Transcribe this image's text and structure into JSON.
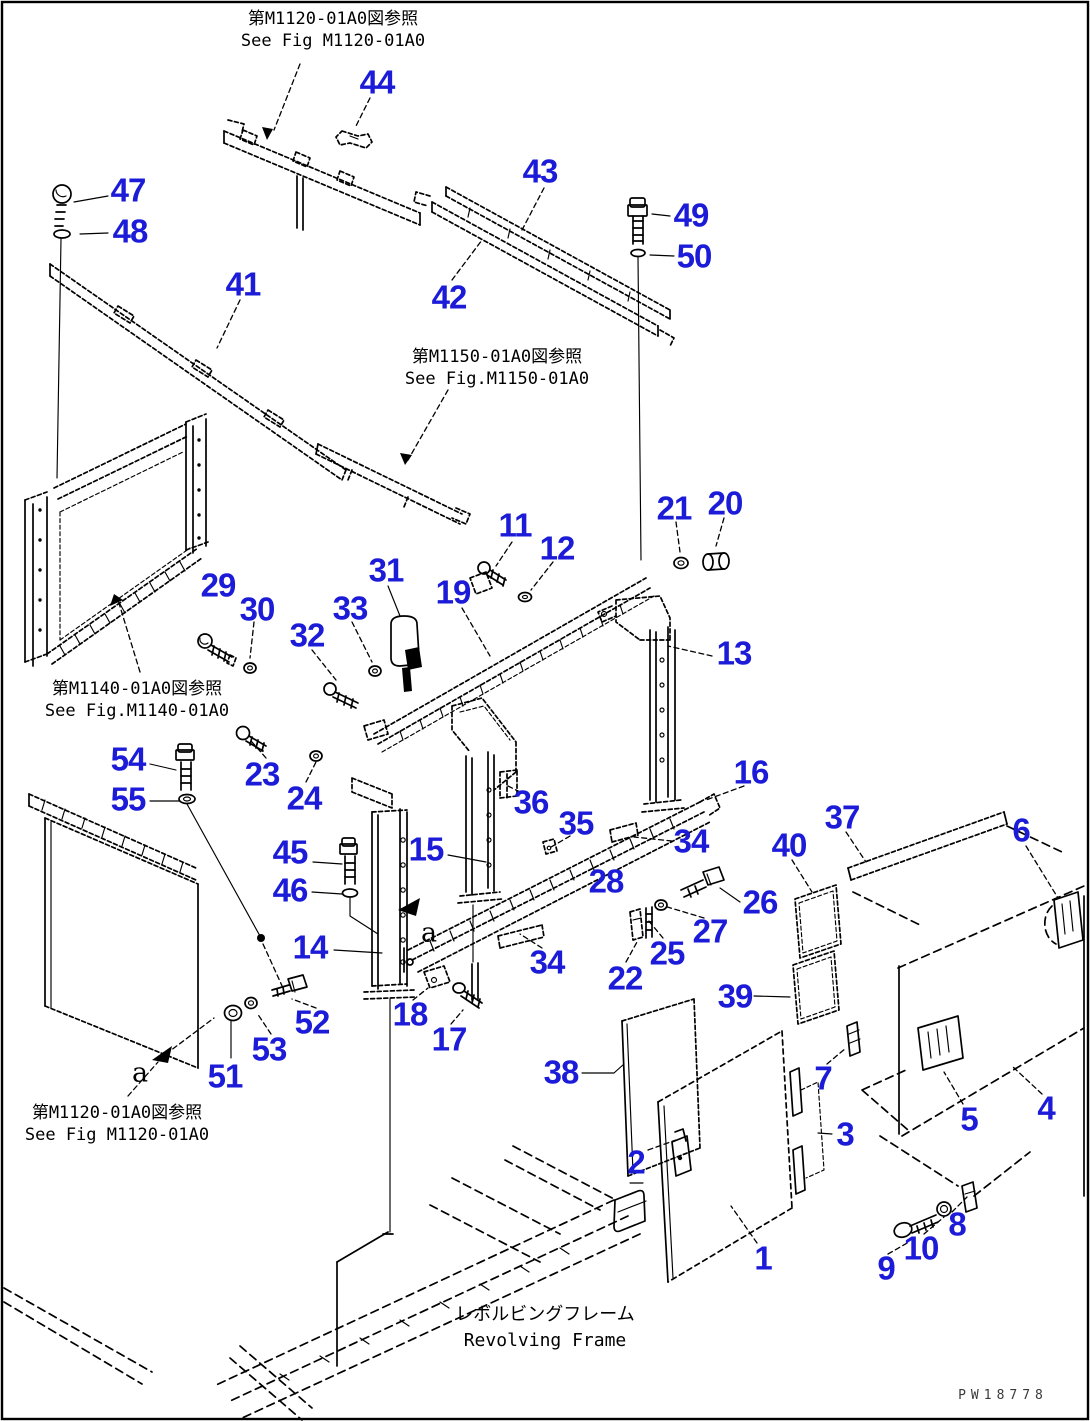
{
  "colors": {
    "callout_blue": "#1b1bd8",
    "line_black": "#000000",
    "background": "#ffffff"
  },
  "figure": {
    "refs": [
      {
        "jp": "第M1120-01A0図参照",
        "en": "See Fig M1120-01A0"
      },
      {
        "jp": "第M1150-01A0図参照",
        "en": "See Fig.M1150-01A0"
      },
      {
        "jp": "第M1140-01A0図参照",
        "en": "See Fig.M1140-01A0"
      },
      {
        "jp": "第M1120-01A0図参照",
        "en": "See Fig M1120-01A0"
      }
    ],
    "caption": {
      "jp": "レボルビングフレーム",
      "en": "Revolving Frame"
    },
    "watermark": "PW18778",
    "view_letters": [
      {
        "label": "a",
        "x": 429,
        "y": 933
      },
      {
        "label": "a",
        "x": 140,
        "y": 1073
      }
    ],
    "callouts": [
      {
        "n": "44",
        "x": 377,
        "y": 82
      },
      {
        "n": "47",
        "x": 128,
        "y": 190
      },
      {
        "n": "48",
        "x": 130,
        "y": 231
      },
      {
        "n": "43",
        "x": 540,
        "y": 171
      },
      {
        "n": "49",
        "x": 691,
        "y": 215
      },
      {
        "n": "50",
        "x": 694,
        "y": 256
      },
      {
        "n": "41",
        "x": 243,
        "y": 284
      },
      {
        "n": "42",
        "x": 449,
        "y": 297
      },
      {
        "n": "11",
        "x": 515,
        "y": 525
      },
      {
        "n": "12",
        "x": 557,
        "y": 548
      },
      {
        "n": "21",
        "x": 674,
        "y": 508
      },
      {
        "n": "20",
        "x": 725,
        "y": 503
      },
      {
        "n": "31",
        "x": 386,
        "y": 570
      },
      {
        "n": "19",
        "x": 453,
        "y": 592
      },
      {
        "n": "29",
        "x": 218,
        "y": 585
      },
      {
        "n": "30",
        "x": 257,
        "y": 609
      },
      {
        "n": "33",
        "x": 350,
        "y": 608
      },
      {
        "n": "32",
        "x": 307,
        "y": 635
      },
      {
        "n": "13",
        "x": 734,
        "y": 653
      },
      {
        "n": "16",
        "x": 751,
        "y": 772
      },
      {
        "n": "54",
        "x": 128,
        "y": 759
      },
      {
        "n": "55",
        "x": 128,
        "y": 799
      },
      {
        "n": "23",
        "x": 262,
        "y": 774
      },
      {
        "n": "24",
        "x": 304,
        "y": 798
      },
      {
        "n": "45",
        "x": 290,
        "y": 852
      },
      {
        "n": "46",
        "x": 290,
        "y": 890
      },
      {
        "n": "15",
        "x": 426,
        "y": 849
      },
      {
        "n": "14",
        "x": 310,
        "y": 947
      },
      {
        "n": "36",
        "x": 531,
        "y": 802
      },
      {
        "n": "35",
        "x": 576,
        "y": 823
      },
      {
        "n": "37",
        "x": 842,
        "y": 817
      },
      {
        "n": "40",
        "x": 789,
        "y": 845
      },
      {
        "n": "34",
        "x": 691,
        "y": 841
      },
      {
        "n": "28",
        "x": 606,
        "y": 881
      },
      {
        "n": "26",
        "x": 760,
        "y": 902
      },
      {
        "n": "27",
        "x": 710,
        "y": 931
      },
      {
        "n": "25",
        "x": 667,
        "y": 953
      },
      {
        "n": "22",
        "x": 625,
        "y": 978
      },
      {
        "n": "34",
        "x": 547,
        "y": 962
      },
      {
        "n": "39",
        "x": 735,
        "y": 996
      },
      {
        "n": "6",
        "x": 1021,
        "y": 830
      },
      {
        "n": "38",
        "x": 561,
        "y": 1072
      },
      {
        "n": "52",
        "x": 312,
        "y": 1022
      },
      {
        "n": "53",
        "x": 269,
        "y": 1049
      },
      {
        "n": "51",
        "x": 225,
        "y": 1076
      },
      {
        "n": "18",
        "x": 410,
        "y": 1014
      },
      {
        "n": "17",
        "x": 449,
        "y": 1039
      },
      {
        "n": "7",
        "x": 823,
        "y": 1078
      },
      {
        "n": "3",
        "x": 845,
        "y": 1134
      },
      {
        "n": "5",
        "x": 969,
        "y": 1119
      },
      {
        "n": "4",
        "x": 1046,
        "y": 1108
      },
      {
        "n": "2",
        "x": 636,
        "y": 1162
      },
      {
        "n": "1",
        "x": 763,
        "y": 1258
      },
      {
        "n": "8",
        "x": 957,
        "y": 1224
      },
      {
        "n": "10",
        "x": 921,
        "y": 1248
      },
      {
        "n": "9",
        "x": 886,
        "y": 1268
      }
    ]
  }
}
